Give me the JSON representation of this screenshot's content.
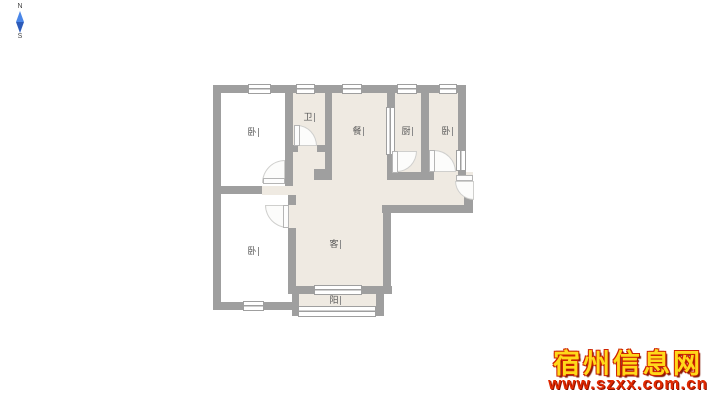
{
  "compass": {
    "north": "N",
    "south": "S"
  },
  "floorplan": {
    "rooms": [
      {
        "id": "bedroom-top-left",
        "label": "卧"
      },
      {
        "id": "bathroom",
        "label": "卫"
      },
      {
        "id": "dining-room",
        "label": "餐"
      },
      {
        "id": "kitchen",
        "label": "厨"
      },
      {
        "id": "bedroom-top-right",
        "label": "卧"
      },
      {
        "id": "living-room",
        "label": "客"
      },
      {
        "id": "bedroom-bottom-left",
        "label": "卧"
      },
      {
        "id": "balcony",
        "label": "阳"
      }
    ],
    "colors": {
      "wall": "#9f9f9f",
      "floor": "#efeae2",
      "floor_alt": "#ffffff"
    }
  },
  "watermark": {
    "site_name": "宿州信息网",
    "site_url": "www.szxx.com.cn",
    "gold": "#ffd91a",
    "red": "#e02800"
  }
}
